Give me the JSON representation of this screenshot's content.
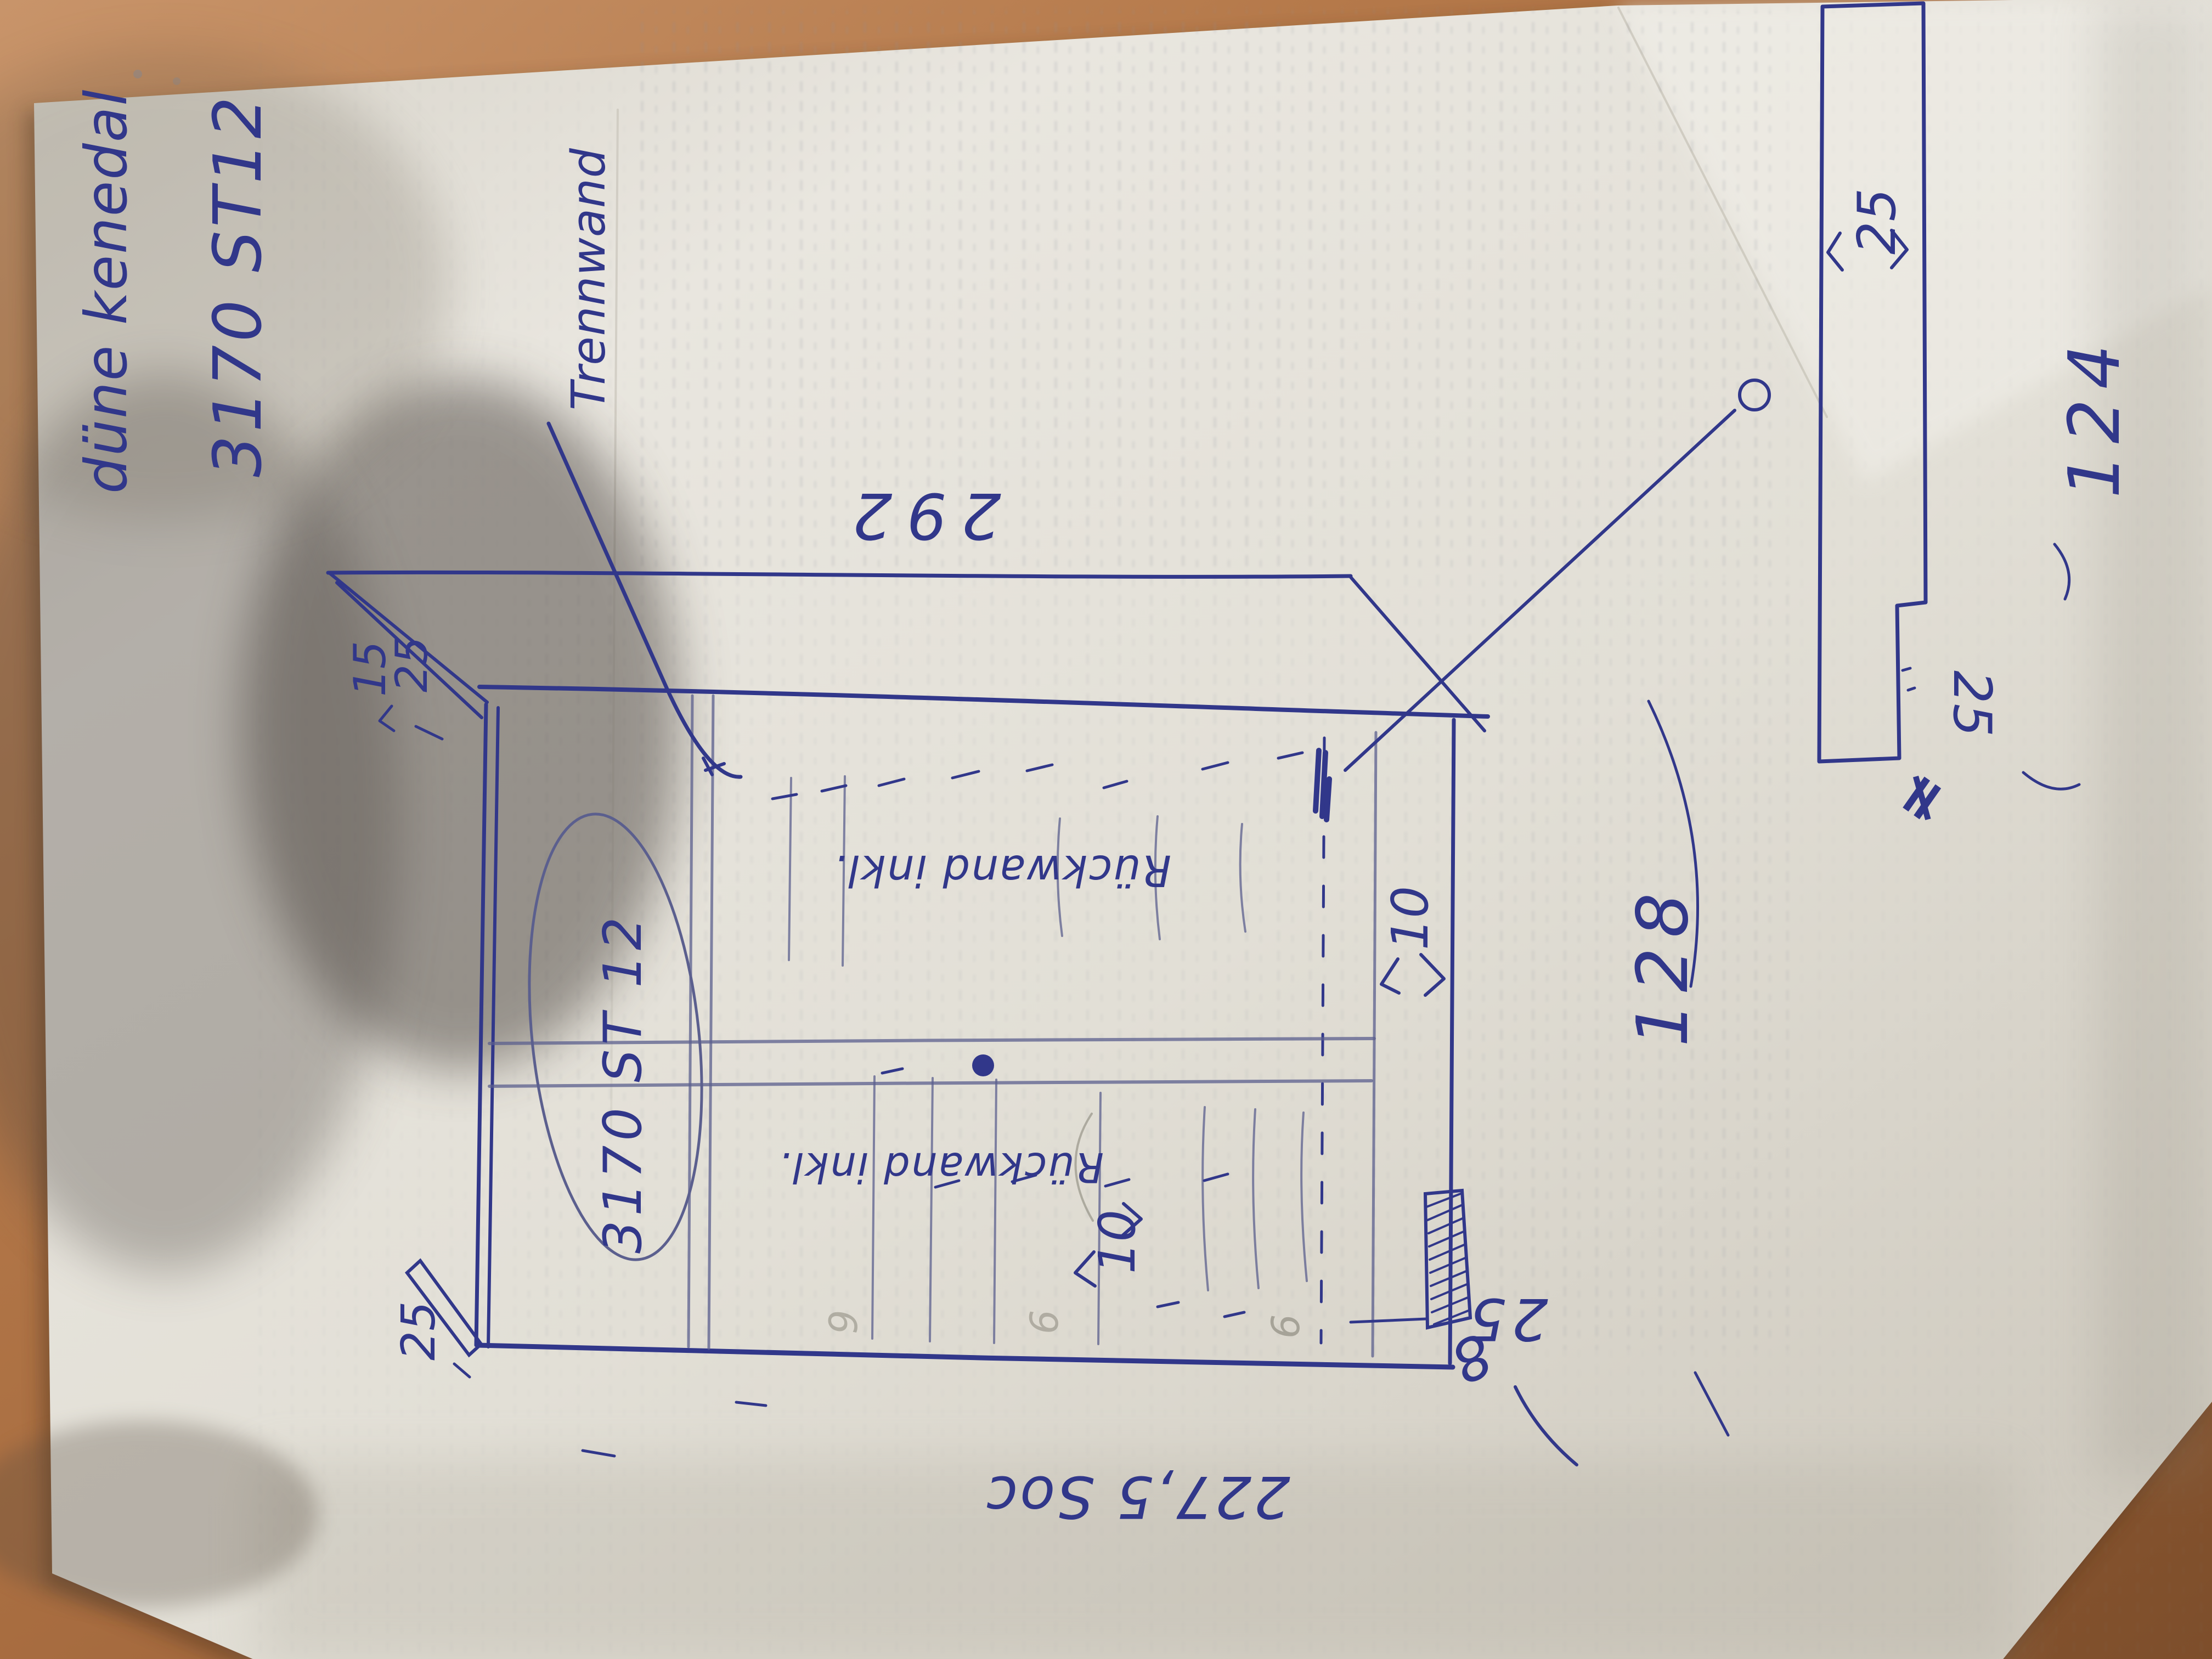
{
  "photo": {
    "title": {
      "name": "düne kenedal",
      "code": "3170 ST12"
    },
    "sketch": {
      "annotation_divider": "Trennwand",
      "dim_top": "292",
      "decor_code": "3170 ST 12",
      "note_right": "Rückwand inkl.",
      "note_left": "Rückwand inkl.",
      "dim_gap_right": "10",
      "dim_gap_left": "10",
      "corner_top_left": {
        "a": "15",
        "b": "25"
      },
      "corner_bottom_left": "25",
      "base_note": "227,5 Soc",
      "dim_door_a": "128",
      "dim_door_b": "124",
      "plinth": {
        "depth": "25",
        "height": "8"
      },
      "detail_strip": {
        "width_top": "25",
        "width_step": "25",
        "mark": "≠"
      },
      "pencil_marks": [
        "9",
        "6",
        "6"
      ]
    },
    "colors": {
      "ink": "#31378a",
      "ink_faint": "#5b5f8e",
      "pencil": "#8b887c",
      "paper": "#e4e1d8",
      "table": "#b5794a"
    }
  }
}
